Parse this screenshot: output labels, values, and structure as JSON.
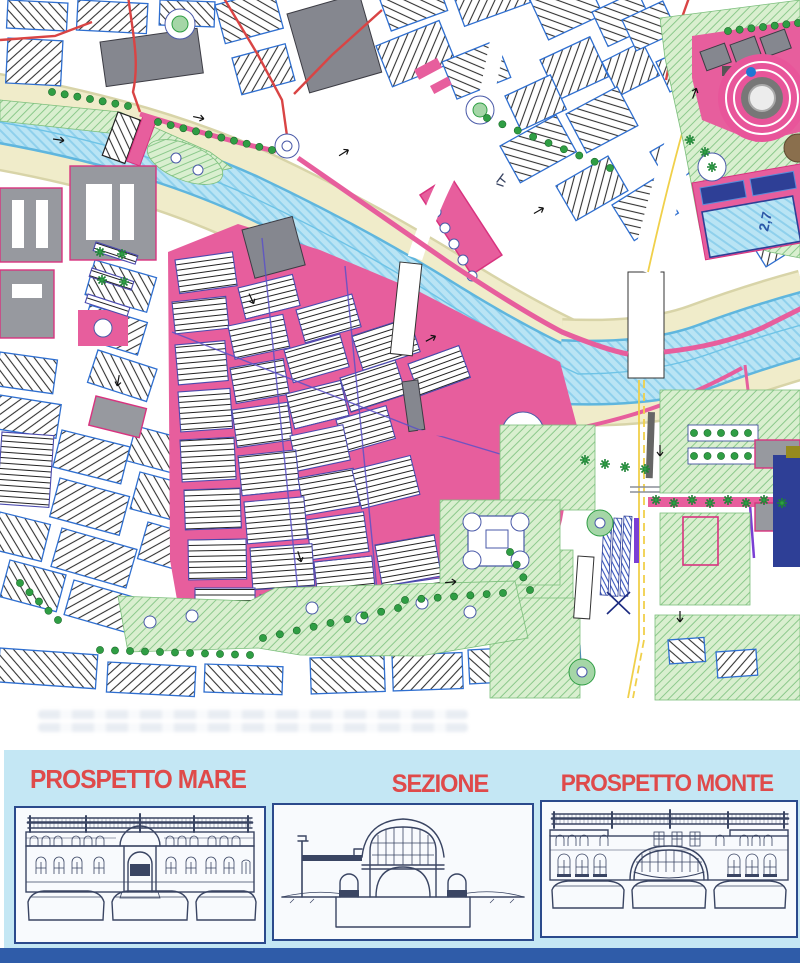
{
  "map": {
    "pool_depth_label": "2,7"
  },
  "panel": {
    "sections": [
      {
        "label": "PROSPETTO MARE"
      },
      {
        "label": "SEZIONE"
      },
      {
        "label": "PROSPETTO MONTE"
      }
    ]
  },
  "theme": {
    "pink": "#e75e9d",
    "pinkDeep": "#d8337f",
    "water": "#b9e4f4",
    "waterDeep": "#5fb6de",
    "cream": "#f0ecca",
    "creamDeep": "#d8d4a8",
    "green": "#d9efcf",
    "tree": "#2f9e44",
    "blockBlue": "#2f6fd0",
    "violet": "#5b51c8",
    "gray": "#97999f",
    "red": "#d94444",
    "yellow": "#f0d04a",
    "navy": "#2e3f96",
    "purple": "#7a3fd4",
    "olive": "#968a1e",
    "panel": "#c4e7f4",
    "titleRed": "#df4a4a",
    "footer": "#2f5ca9",
    "ink": "#3a4563"
  }
}
